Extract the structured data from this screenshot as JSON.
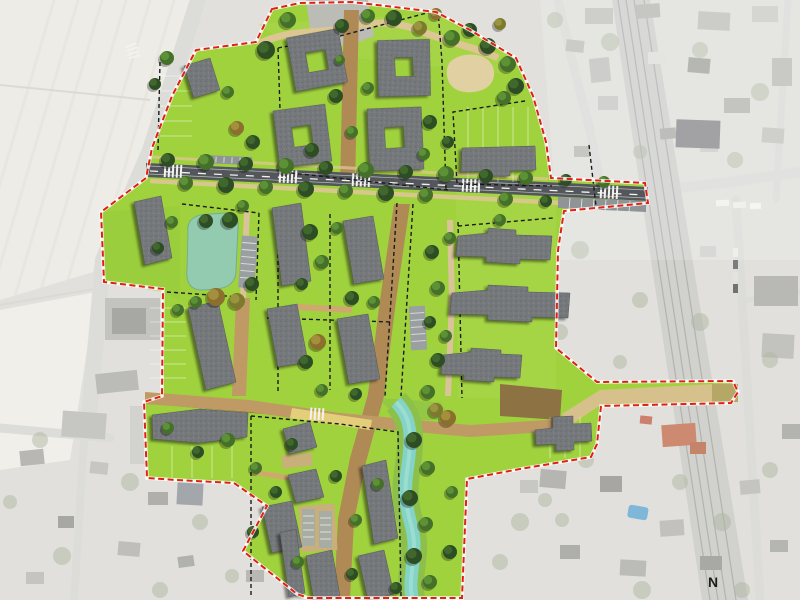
{
  "map": {
    "north_label": "N",
    "features": [
      {
        "name": "site-boundary",
        "style": "red-dashed-line"
      },
      {
        "name": "parcel-boundaries",
        "style": "black-dashed-line"
      },
      {
        "name": "new-housing-blocks",
        "style": "gray-roof-buildings"
      },
      {
        "name": "main-street",
        "style": "asphalt-with-crosswalks"
      },
      {
        "name": "residential-paths",
        "style": "tan-gravel"
      },
      {
        "name": "pond",
        "style": "teal-water"
      },
      {
        "name": "stream",
        "style": "teal-water-corridor"
      },
      {
        "name": "railway",
        "style": "gray-track-band"
      },
      {
        "name": "existing-town",
        "style": "desaturated-aerial-photo"
      }
    ]
  },
  "colors": {
    "site-green": "#a0d23e",
    "boundary-red": "#e02015",
    "parcel-dash": "#1b1b1b",
    "building-gray": "#76797c",
    "road-asphalt": "#53575b",
    "road-marking": "#f2f2ef",
    "path-tan": "#bf9a64",
    "path-sand": "#dcc792",
    "gravel-brown": "#8d7244",
    "shared-zone-yellow": "#e9d87d",
    "pond-teal": "#93cbb0",
    "stream-teal": "#83d3c6",
    "aerial-ground": "#d9d8d3",
    "aerial-field": "#e9e7e0",
    "aerial-road": "#d3d3cf",
    "aerial-building": "#b0b0ac",
    "railway-gray": "#c4c4c0",
    "pool-blue": "#5ca3cf",
    "roof-orange": "#c06a48",
    "north-label-color": "#1c1c1c"
  }
}
